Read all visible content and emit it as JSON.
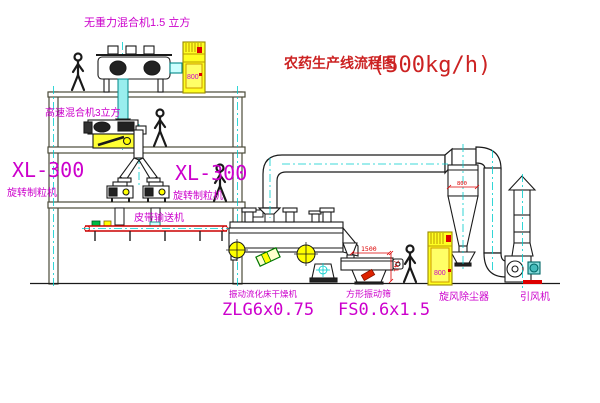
{
  "title": {
    "cn": "农药生产线流程图",
    "capacity": "(500kg/h)"
  },
  "labels": {
    "mixer_top": "无重力混合机1.5 立方",
    "mixer_2f": "高速混合机3立方",
    "granulator_left_model": "XL-300",
    "granulator_left_name": "旋转制粒机",
    "granulator_right_model": "XL-300",
    "granulator_right_name": "旋转制粒机",
    "belt_conveyor": "皮带输送机",
    "dryer_name": "振动流化床干燥机",
    "dryer_model": "ZLG6x0.75",
    "screen_name": "方形振动筛",
    "screen_model": "FS0.6x1.5",
    "cyclone": "旋风除尘器",
    "fan": "引风机"
  },
  "dimensions": {
    "screen_length": "1500",
    "screen_height": "741",
    "cyclone_dia": "800",
    "cabinet_top_tag": "800",
    "cabinet_bottom_tag": "800"
  },
  "colors": {
    "background": "#ffffff",
    "label_magenta": "#cc00cc",
    "title_red": "#cc2222",
    "dimension_red": "#dd0000",
    "structure_line": "#4b4b3a",
    "equipment_line": "#1a1a1a",
    "centerline_cyan": "#00cccc",
    "highlight_yellow": "#ffff22",
    "conveyor_red": "#cc0000"
  }
}
